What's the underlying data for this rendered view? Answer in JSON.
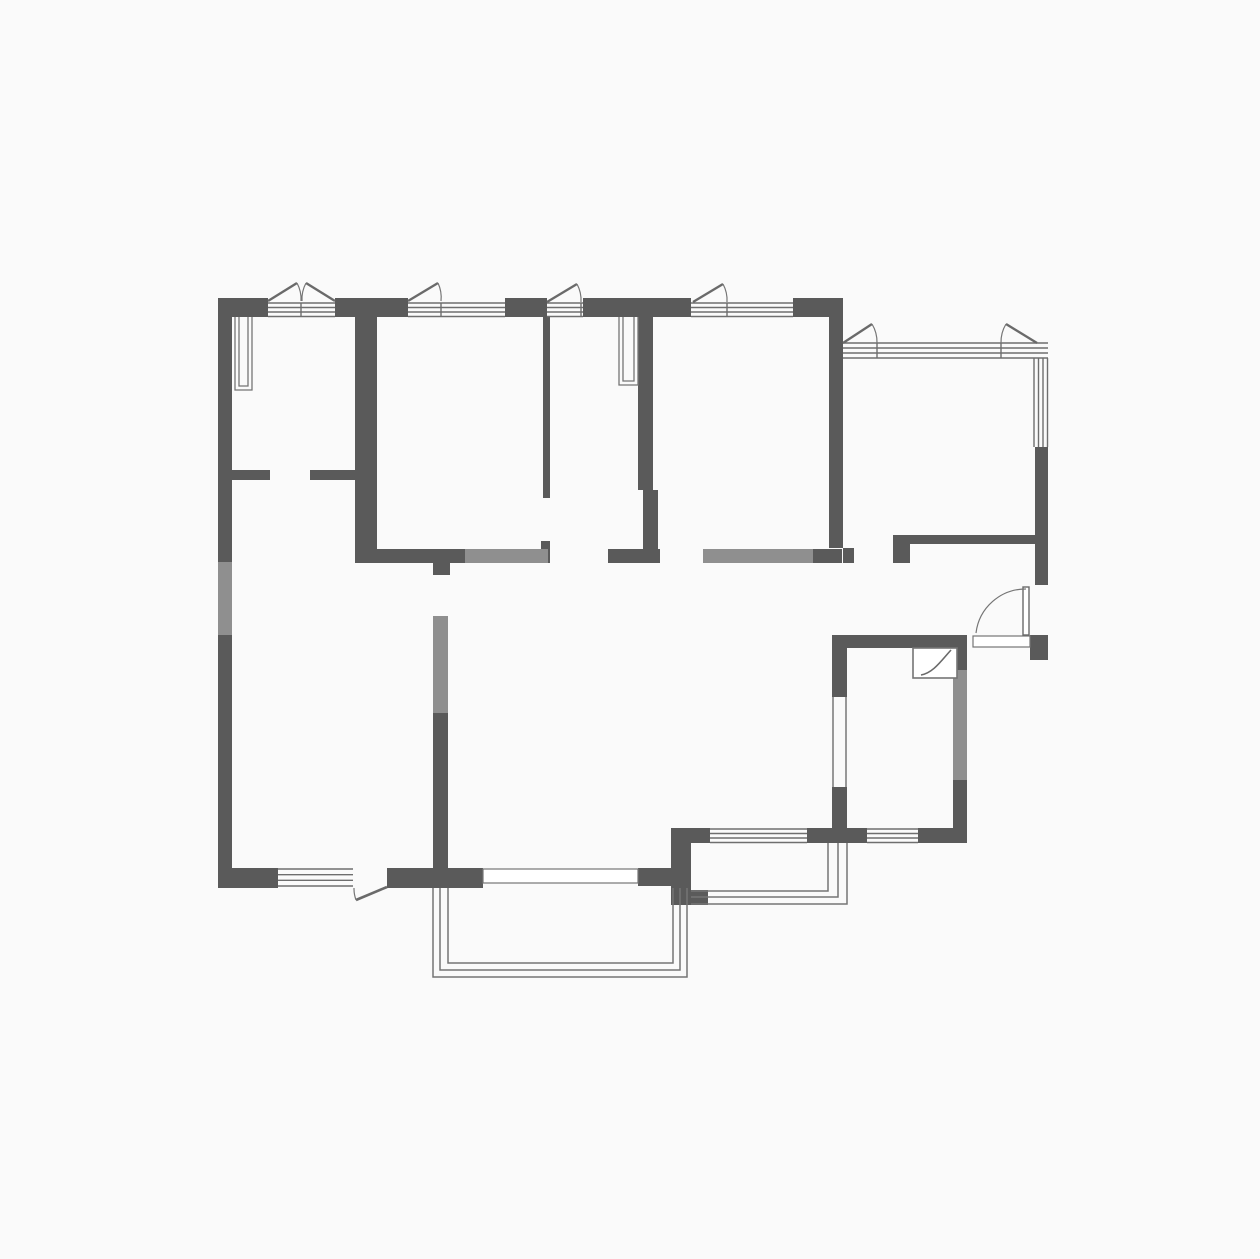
{
  "canvas": {
    "width": 1260,
    "height": 1259,
    "background": "#fafafa"
  },
  "colors": {
    "wall_dark": "#5a5a5a",
    "wall_light": "#8f8f8f",
    "line": "#757575",
    "glazing": "#6e6e6e",
    "leaf": "#6a6a6a",
    "white": "#ffffff"
  },
  "walls_dark": [
    [
      218,
      298,
      14,
      265
    ],
    [
      218,
      635,
      14,
      253
    ],
    [
      218,
      298,
      50,
      19
    ],
    [
      335,
      298,
      73,
      19
    ],
    [
      505,
      298,
      42,
      19
    ],
    [
      583,
      298,
      108,
      19
    ],
    [
      793,
      298,
      50,
      19
    ],
    [
      829,
      317,
      14,
      231
    ],
    [
      843,
      548,
      11,
      15
    ],
    [
      355,
      317,
      22,
      246
    ],
    [
      232,
      470,
      38,
      10
    ],
    [
      310,
      470,
      45,
      10
    ],
    [
      543,
      317,
      7,
      181
    ],
    [
      541,
      541,
      9,
      22
    ],
    [
      355,
      549,
      110,
      14
    ],
    [
      433,
      563,
      17,
      12
    ],
    [
      638,
      317,
      15,
      173
    ],
    [
      643,
      490,
      15,
      59
    ],
    [
      608,
      549,
      52,
      14
    ],
    [
      813,
      549,
      29,
      14
    ],
    [
      433,
      713,
      15,
      155
    ],
    [
      218,
      868,
      60,
      20
    ],
    [
      387,
      868,
      96,
      20
    ],
    [
      638,
      868,
      53,
      18
    ],
    [
      671,
      828,
      20,
      77
    ],
    [
      671,
      890,
      37,
      15
    ],
    [
      671,
      828,
      39,
      15
    ],
    [
      807,
      828,
      60,
      15
    ],
    [
      918,
      828,
      49,
      15
    ],
    [
      832,
      647,
      15,
      50
    ],
    [
      832,
      787,
      15,
      41
    ],
    [
      953,
      647,
      14,
      23
    ],
    [
      953,
      780,
      14,
      63
    ],
    [
      832,
      635,
      135,
      13
    ],
    [
      1030,
      635,
      18,
      25
    ],
    [
      1035,
      447,
      13,
      138
    ],
    [
      905,
      535,
      130,
      9
    ],
    [
      893,
      535,
      17,
      28
    ]
  ],
  "walls_light": [
    [
      218,
      562,
      14,
      73
    ],
    [
      465,
      549,
      83,
      14
    ],
    [
      703,
      549,
      110,
      14
    ],
    [
      433,
      616,
      15,
      97
    ],
    [
      953,
      670,
      14,
      110
    ]
  ],
  "window_groups": [
    {
      "o": "h",
      "x": 268,
      "y": 303,
      "len": 67,
      "span": 13.5,
      "n": 4
    },
    {
      "o": "h",
      "x": 408,
      "y": 303,
      "len": 97,
      "span": 13.5,
      "n": 4
    },
    {
      "o": "h",
      "x": 547,
      "y": 303,
      "len": 36,
      "span": 13.5,
      "n": 4
    },
    {
      "o": "h",
      "x": 691,
      "y": 303,
      "len": 102,
      "span": 13.5,
      "n": 4
    },
    {
      "o": "h",
      "x": 843,
      "y": 343,
      "len": 205,
      "span": 15,
      "n": 4
    },
    {
      "o": "v",
      "x": 1034,
      "y": 358,
      "len": 89,
      "span": 13.5,
      "n": 4
    },
    {
      "o": "h",
      "x": 278,
      "y": 869,
      "len": 75,
      "span": 17,
      "n": 4
    },
    {
      "o": "h",
      "x": 710,
      "y": 829,
      "len": 97,
      "span": 13.5,
      "n": 4
    },
    {
      "o": "h",
      "x": 867,
      "y": 829,
      "len": 51,
      "span": 13.5,
      "n": 4
    },
    {
      "o": "v",
      "x": 833,
      "y": 697,
      "len": 90,
      "span": 13,
      "n": 2
    }
  ],
  "mullions": [
    [
      301,
      303,
      14
    ],
    [
      441,
      303,
      14
    ],
    [
      581,
      303,
      14
    ],
    [
      727,
      303,
      14
    ],
    [
      877,
      343,
      15
    ],
    [
      1001,
      343,
      15
    ]
  ],
  "casements": [
    {
      "hinge": [
        268,
        301
      ],
      "tip": [
        297,
        283
      ],
      "jamb": [
        301,
        301
      ],
      "r": 34,
      "sweep": 1
    },
    {
      "hinge": [
        335,
        301
      ],
      "tip": [
        306,
        283
      ],
      "jamb": [
        302,
        301
      ],
      "r": 34,
      "sweep": 0
    },
    {
      "hinge": [
        408,
        301
      ],
      "tip": [
        438,
        283
      ],
      "jamb": [
        441,
        301
      ],
      "r": 34,
      "sweep": 1
    },
    {
      "hinge": [
        547,
        302
      ],
      "tip": [
        577,
        284
      ],
      "jamb": [
        581,
        302
      ],
      "r": 34,
      "sweep": 1
    },
    {
      "hinge": [
        693,
        302
      ],
      "tip": [
        723,
        284
      ],
      "jamb": [
        727,
        302
      ],
      "r": 34,
      "sweep": 1
    },
    {
      "hinge": [
        843,
        343
      ],
      "tip": [
        872,
        324
      ],
      "jamb": [
        877,
        343
      ],
      "r": 35,
      "sweep": 1
    },
    {
      "hinge": [
        1037,
        343
      ],
      "tip": [
        1006,
        324
      ],
      "jamb": [
        1001,
        343
      ],
      "r": 35,
      "sweep": 0
    }
  ],
  "doors": {
    "balcony_leaf": [
      387,
      887,
      356,
      900
    ],
    "balcony_arc": "M354,888 A33,33 0 0 0 356,900",
    "entry_leaf_rect": [
      1023,
      587,
      6,
      48
    ],
    "entry_arc": "M1026,589 A50,50 0 0 0 976,633",
    "bath_box": [
      913,
      648,
      44,
      30
    ],
    "bath_curve": "M921,675 C933,673 941,661 951,650"
  },
  "openings": [
    [
      483,
      869,
      155,
      14
    ],
    [
      973,
      636,
      57,
      11
    ]
  ],
  "balcony_paths": [
    "M433,888 L433,977 L687,977 L687,888",
    "M440,888 L440,970 L680,970 L680,888",
    "M448,888 L448,963 L673,963 L673,888",
    "M691,891 L828,891 L828,843",
    "M691,897 L838,897 L838,843",
    "M691,904 L847,904 L847,843"
  ],
  "flue_paths": [
    "M235,317 L235,390 L252,390 L252,317",
    "M239,317 L239,386 L248,386 L248,317",
    "M619,317 L619,385 L638,385 L638,317",
    "M623,317 L623,381 L634,381 L634,317"
  ]
}
